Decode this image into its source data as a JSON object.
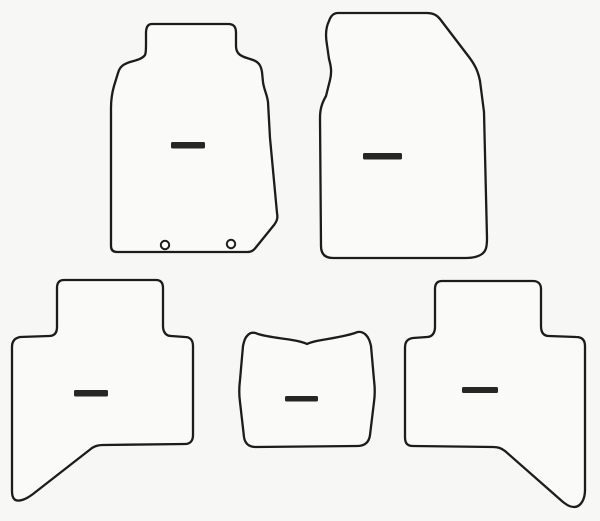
{
  "image": {
    "width": 600,
    "height": 521,
    "background_color": "#f7f7f6",
    "outline_color": "#1c1c1c",
    "mat_fill_color": "#fafaf9",
    "label_color": "#262626",
    "eyelet_fill_color": "#fdfdfd",
    "stroke_width": 2.3
  },
  "mats": [
    {
      "id": "front-driver-mat",
      "name": "front-driver-mat",
      "path": "M 152 24 H 228 C 234 24 236 27 236 33 V 46 C 236 53 240 56 247 58 L 253 60 C 259 62 261 66 262 72 L 263 82 C 264 90 267 94 268 102 L 270 138 L 277 213 C 278 218 277 221 274 225 L 257 246 C 254 250 252 252 247 252 H 117 C 113 252 111 250 111 246 V 108 C 111 99 112 93 114 86 L 118 73 C 120 66 124 64 130 62 C 137 60 142 59 145 55 C 146 53 146 50 146 45 V 33 C 146 27 148 24 152 24 Z",
      "label_dash": {
        "x": 171,
        "y": 142,
        "width": 34,
        "height": 6.5
      },
      "eyelets": [
        {
          "cx": 165,
          "cy": 245,
          "r": 4.2
        },
        {
          "cx": 231,
          "cy": 244,
          "r": 4.2
        }
      ]
    },
    {
      "id": "front-passenger-mat",
      "name": "front-passenger-mat",
      "path": "M 338 13 H 427 C 433 13 437 15 440 19 L 469 57 C 475 65 478 71 480 81 L 484 112 L 487 238 C 487 247 486 251 482 254 C 478 257 473 258 466 258 H 333 C 325 258 321 254 321 246 L 320 118 C 320 109 322 103 326 96 L 330 80 C 332 72 331 66 329 59 L 327 45 C 325 34 326 27 329 21 C 331 15 334 13 338 13 Z",
      "label_dash": {
        "x": 363,
        "y": 153,
        "width": 39,
        "height": 6.5
      },
      "eyelets": []
    },
    {
      "id": "rear-left-mat",
      "name": "rear-left-mat",
      "path": "M 64 280 H 156 C 161 280 163 283 163 288 V 326 C 163 332 166 336 171 336 L 185 337 C 190 337 193 340 193 346 V 435 C 193 441 190 444 185 444 L 103 445 C 98 445 95 446 92 448 L 33 494 C 29 497 26 499 22 500 C 15 502 12 499 12 491 V 347 C 12 341 15 338 20 337 L 49 336 C 55 336 57 332 57 327 V 288 C 57 283 59 280 64 280 Z",
      "label_dash": {
        "x": 74,
        "y": 390,
        "width": 34,
        "height": 6.5
      },
      "eyelets": []
    },
    {
      "id": "center-tunnel-mat",
      "name": "center-tunnel-mat",
      "path": "M 247 336 C 250 332 254 332 258 334 C 268 337 280 338 292 340 C 298 341 303 342 307 344 C 311 342 316 341 322 340 C 334 338 346 336 355 333 C 359 331 363 332 366 335 C 369 338 370 342 371 346 L 374 380 C 375 388 375 395 374 402 L 370 435 C 369 443 364 446 357 446 L 256 447 C 249 447 245 444 244 437 L 240 402 C 239 395 239 388 240 380 L 243 346 C 244 341 245 338 247 336 Z",
      "label_dash": {
        "x": 285,
        "y": 396,
        "width": 33,
        "height": 5.5
      },
      "eyelets": []
    },
    {
      "id": "rear-right-mat",
      "name": "rear-right-mat",
      "path": "M 442 281 H 533 C 538 281 541 284 541 289 V 326 C 541 332 543 336 549 336 L 576 337 C 582 337 585 340 585 346 V 490 C 585 499 581 507 574 507 C 570 507 567 505 563 502 L 505 451 C 501 448 498 447 493 447 L 413 446 C 407 446 405 443 405 437 V 348 C 405 342 407 339 413 338 L 427 337 C 432 337 435 333 435 327 V 289 C 435 284 437 281 442 281 Z",
      "label_dash": {
        "x": 462,
        "y": 387,
        "width": 36,
        "height": 6
      },
      "eyelets": []
    }
  ]
}
